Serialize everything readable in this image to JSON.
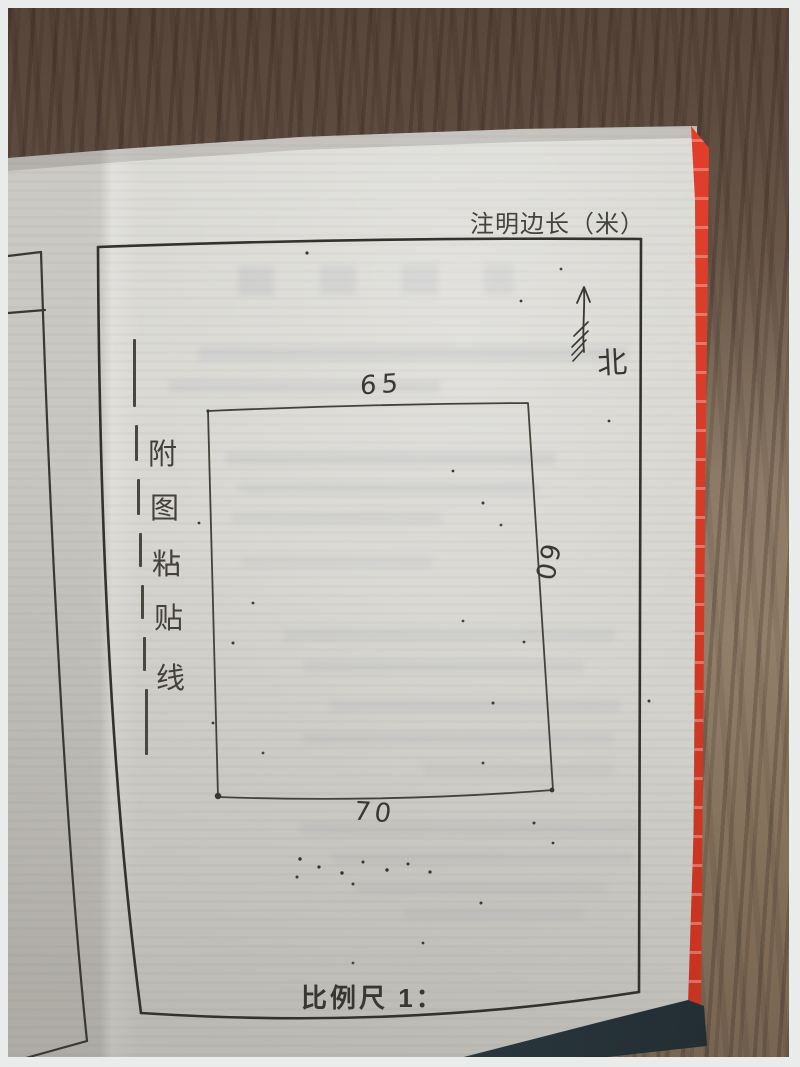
{
  "page": {
    "header_note": "注明边长（米）",
    "north_label": "北",
    "paste_line_chars": [
      "附",
      "图",
      "粘",
      "贴",
      "线"
    ],
    "parcel_dimensions": {
      "top": "65",
      "right": "60",
      "bottom": "70"
    },
    "scale_label": "比例尺 1："
  },
  "colors": {
    "cover-red": "#d63b27",
    "cover-dark": "#2c3a41",
    "paper": "#d9d8d3",
    "ink": "#3c3a34",
    "wood-dark": "#564439",
    "wood-light": "#92806d",
    "photo-border": "#eaecec"
  }
}
